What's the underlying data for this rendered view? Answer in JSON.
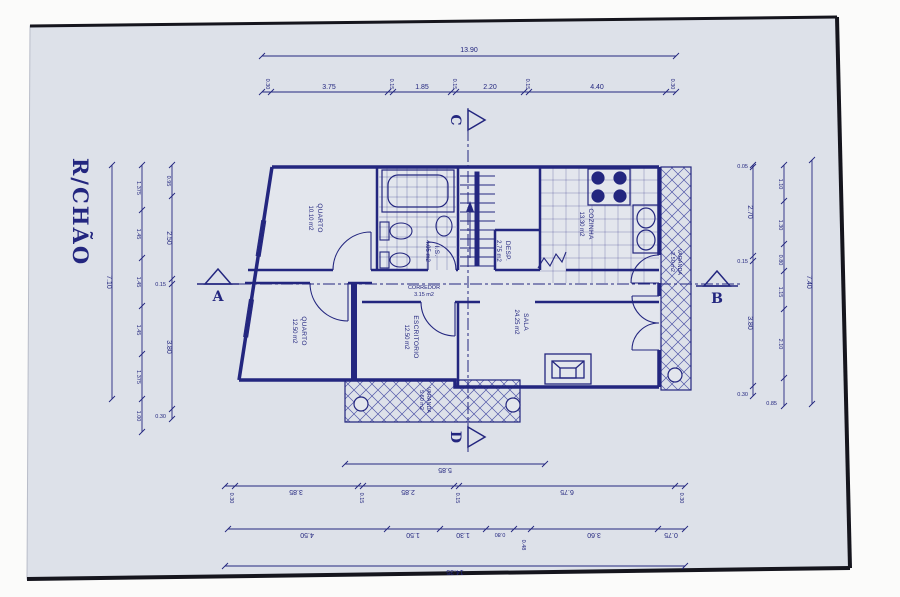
{
  "drawing": {
    "title": "R/CHÃO",
    "watermark": "zome",
    "ink_color": "#23267f",
    "paper_color": "#dde1e9",
    "sections": {
      "a": "A",
      "b": "B",
      "c": "C",
      "d": "D"
    }
  },
  "rooms": {
    "quarto1": {
      "name": "QUARTO",
      "area": "10.10 m2"
    },
    "wc": {
      "name": "I.S.",
      "area": "4.05 m2"
    },
    "cozinha": {
      "name": "COZINHA",
      "area": "13.30 m2"
    },
    "desp": {
      "name": "DESP.",
      "area": "2.75 m2"
    },
    "corredor": {
      "name": "CORREDOR",
      "area": "3.15 m2"
    },
    "quarto2": {
      "name": "QUARTO",
      "area": "12.50 m2"
    },
    "escritorio": {
      "name": "ESCRITORIO",
      "area": "12.50 m2"
    },
    "sala": {
      "name": "SALA",
      "area": "24.25 m2"
    },
    "varanda_sul": {
      "name": "VARANDA",
      "area": "5.60 m2"
    },
    "varanda_este": {
      "name": "VARANDA",
      "area": "2.50 m2"
    }
  },
  "dims": {
    "top": {
      "total": "13.90",
      "chain": [
        "0.30",
        "3.75",
        "0.15",
        "1.85",
        "0.15",
        "2.20",
        "0.15",
        "4.40",
        "0.30"
      ]
    },
    "left": {
      "total": "7.10",
      "mid": [
        "1.375",
        "1.45",
        "1.45",
        "1.45",
        "1.375",
        "1.00"
      ],
      "inner": [
        "0.95",
        "2.50",
        "0.15",
        "3.80",
        "0.30"
      ]
    },
    "right": {
      "total": "7.40",
      "mid": [
        "1.10",
        "1.30",
        "0.80",
        "1.15",
        "2.10",
        "0.85"
      ],
      "inner": [
        "0.05",
        "2.70",
        "0.15",
        "3.80",
        "0.30"
      ]
    },
    "bottom": {
      "varanda": "5.85",
      "chain1": [
        "0.30",
        "3.85",
        "0.15",
        "2.85",
        "0.15",
        "6.75",
        "0.30"
      ],
      "chain2": [
        "4.50",
        "1.50",
        "1.30",
        "0.80",
        "0.48",
        "3.60",
        "0.75"
      ],
      "total": "14.35"
    }
  }
}
